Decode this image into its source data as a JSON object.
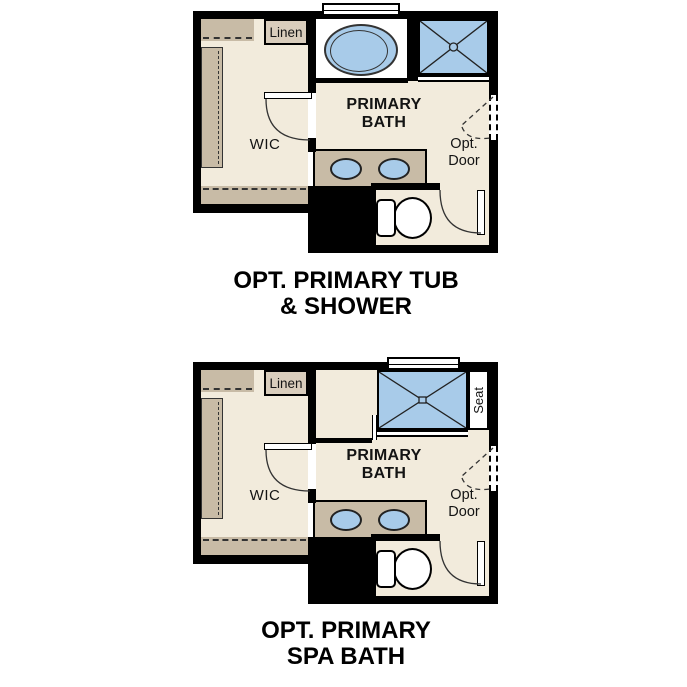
{
  "colors": {
    "floor": "#F2EBDC",
    "cabinet": "#C8BBA6",
    "linen_fill": "#D9CDBC",
    "fixture_blue": "#A8CBE9",
    "wall": "#000000",
    "text": "#141414"
  },
  "plan_tub_shower": {
    "caption": [
      "OPT. PRIMARY TUB",
      "& SHOWER"
    ],
    "linen_label": "Linen",
    "wic_label": "WIC",
    "room_label": [
      "PRIMARY",
      "BATH"
    ],
    "opt_door_label": [
      "Opt.",
      "Door"
    ]
  },
  "plan_spa_bath": {
    "caption": [
      "OPT. PRIMARY",
      "SPA BATH"
    ],
    "linen_label": "Linen",
    "wic_label": "WIC",
    "room_label": [
      "PRIMARY",
      "BATH"
    ],
    "opt_door_label": [
      "Opt.",
      "Door"
    ],
    "seat_label": "Seat"
  }
}
